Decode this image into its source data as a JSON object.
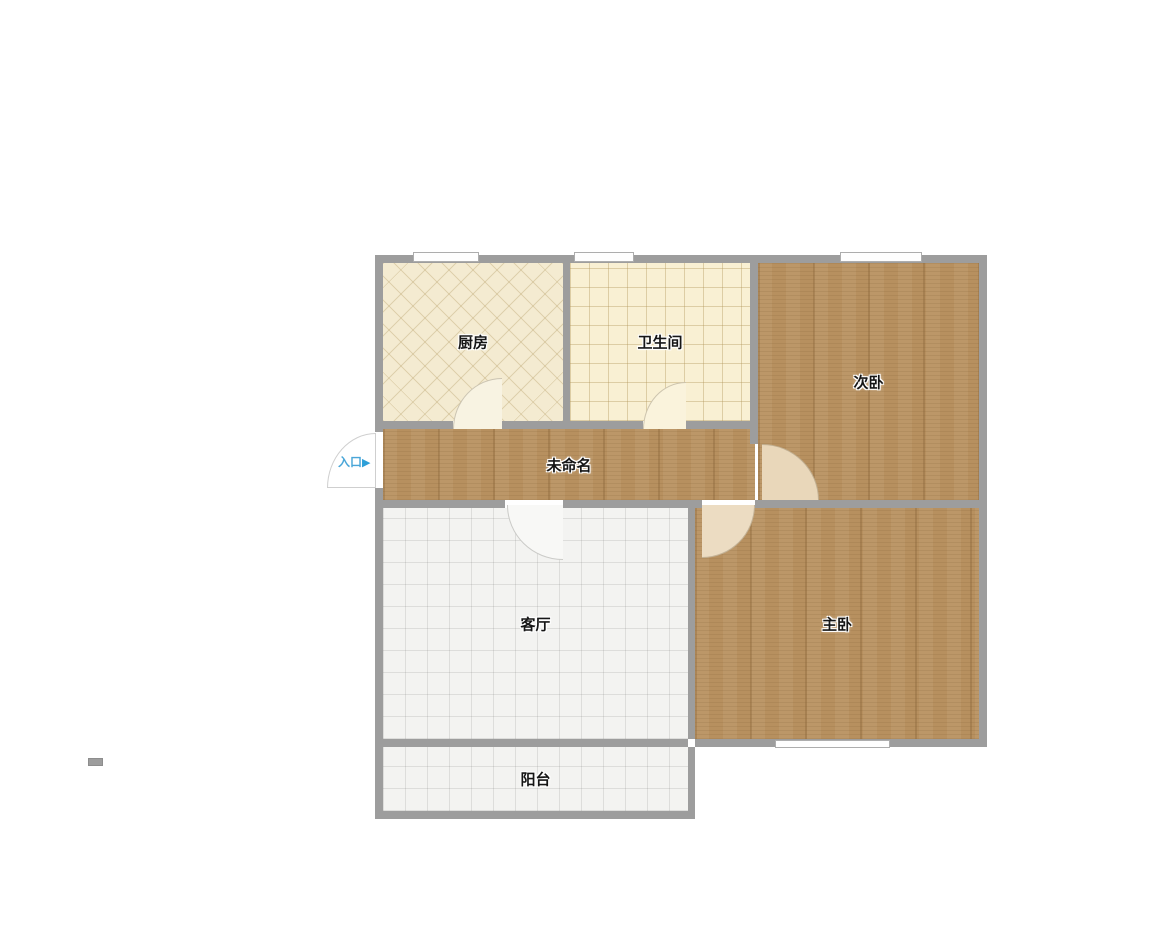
{
  "floorplan": {
    "rooms": [
      {
        "id": "kitchen",
        "label": "厨房"
      },
      {
        "id": "bathroom",
        "label": "卫生间"
      },
      {
        "id": "secondary-bedroom",
        "label": "次卧"
      },
      {
        "id": "hallway",
        "label": "未命名"
      },
      {
        "id": "living-room",
        "label": "客厅"
      },
      {
        "id": "master-bedroom",
        "label": "主卧"
      },
      {
        "id": "balcony",
        "label": "阳台"
      }
    ],
    "entrance": {
      "label": "入口",
      "arrow": "▶"
    },
    "colors": {
      "wall": "#9d9d9d",
      "wood_floor": "#b7905f",
      "kitchen_floor": "#f4ebd1",
      "bathroom_floor": "#f9f0d3",
      "tile_floor": "#f3f3f1",
      "window": "#fefefe",
      "entrance_blue": "#4aa6d8"
    }
  }
}
